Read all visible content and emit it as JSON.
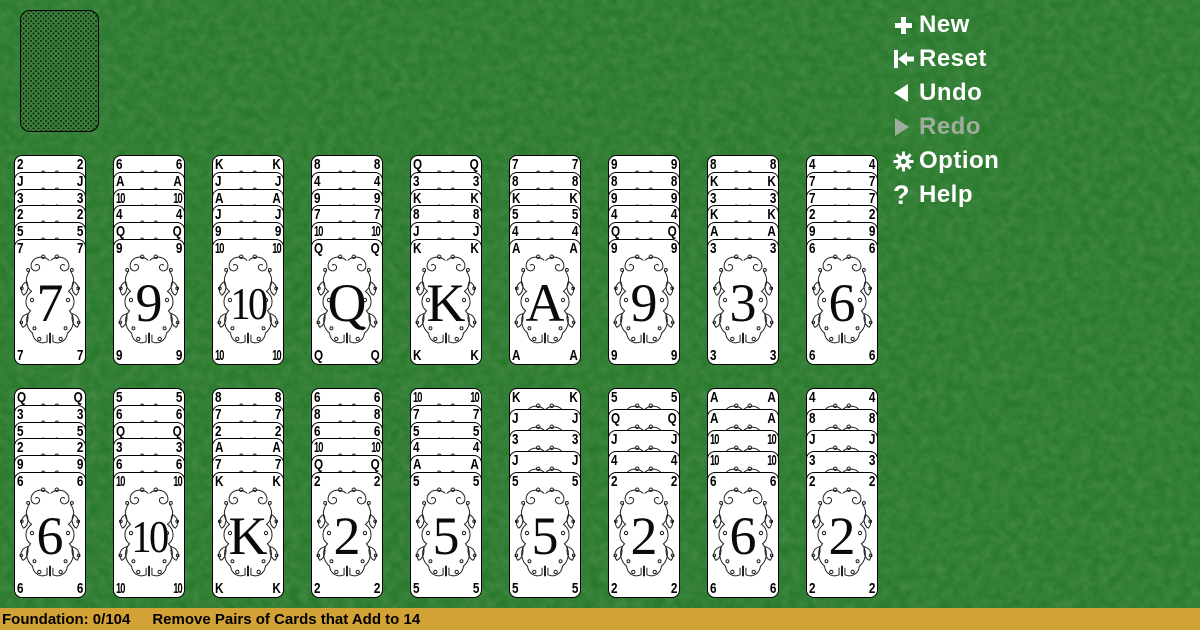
{
  "colors": {
    "background": "#2f7d32",
    "status_bar_background": "#d2a236",
    "menu_text": "#ffffff",
    "menu_disabled_text": "#9fae9c",
    "card_face": "#ffffff",
    "card_ink": "#000000"
  },
  "menu": {
    "items": [
      {
        "id": "new",
        "label": "New",
        "icon": "plus-icon",
        "enabled": true
      },
      {
        "id": "reset",
        "label": "Reset",
        "icon": "reset-icon",
        "enabled": true
      },
      {
        "id": "undo",
        "label": "Undo",
        "icon": "undo-icon",
        "enabled": true
      },
      {
        "id": "redo",
        "label": "Redo",
        "icon": "redo-icon",
        "enabled": false
      },
      {
        "id": "option",
        "label": "Option",
        "icon": "gear-icon",
        "enabled": true
      },
      {
        "id": "help",
        "label": "Help",
        "icon": "question-icon",
        "enabled": true
      }
    ]
  },
  "stock": {
    "face_down": true
  },
  "tableau": {
    "row1": [
      {
        "hidden": [
          "2",
          "J",
          "3",
          "2",
          "5"
        ],
        "top": "7"
      },
      {
        "hidden": [
          "6",
          "A",
          "10",
          "4",
          "Q"
        ],
        "top": "9"
      },
      {
        "hidden": [
          "K",
          "J",
          "A",
          "J",
          "9"
        ],
        "top": "10"
      },
      {
        "hidden": [
          "8",
          "4",
          "9",
          "7",
          "10"
        ],
        "top": "Q"
      },
      {
        "hidden": [
          "Q",
          "3",
          "K",
          "8",
          "J"
        ],
        "top": "K"
      },
      {
        "hidden": [
          "7",
          "8",
          "K",
          "5",
          "4"
        ],
        "top": "A"
      },
      {
        "hidden": [
          "9",
          "8",
          "9",
          "4",
          "Q"
        ],
        "top": "9"
      },
      {
        "hidden": [
          "8",
          "K",
          "3",
          "K",
          "A"
        ],
        "top": "3"
      },
      {
        "hidden": [
          "4",
          "7",
          "7",
          "2",
          "9"
        ],
        "top": "6"
      }
    ],
    "row2": [
      {
        "hidden": [
          "Q",
          "3",
          "5",
          "2",
          "9"
        ],
        "top": "6"
      },
      {
        "hidden": [
          "5",
          "6",
          "Q",
          "3",
          "6"
        ],
        "top": "10"
      },
      {
        "hidden": [
          "8",
          "7",
          "2",
          "A",
          "7"
        ],
        "top": "K"
      },
      {
        "hidden": [
          "6",
          "8",
          "6",
          "10",
          "Q"
        ],
        "top": "2"
      },
      {
        "hidden": [
          "10",
          "7",
          "5",
          "4",
          "A"
        ],
        "top": "5"
      },
      {
        "hidden": [
          "K",
          "J",
          "3",
          "J"
        ],
        "top": "5"
      },
      {
        "hidden": [
          "5",
          "Q",
          "J",
          "4"
        ],
        "top": "2"
      },
      {
        "hidden": [
          "A",
          "A",
          "10",
          "10"
        ],
        "top": "6"
      },
      {
        "hidden": [
          "4",
          "8",
          "J",
          "3"
        ],
        "top": "2"
      }
    ]
  },
  "status_bar": {
    "foundation_text": "Foundation: 0/104",
    "hint_text": "Remove Pairs of Cards that Add to 14"
  }
}
